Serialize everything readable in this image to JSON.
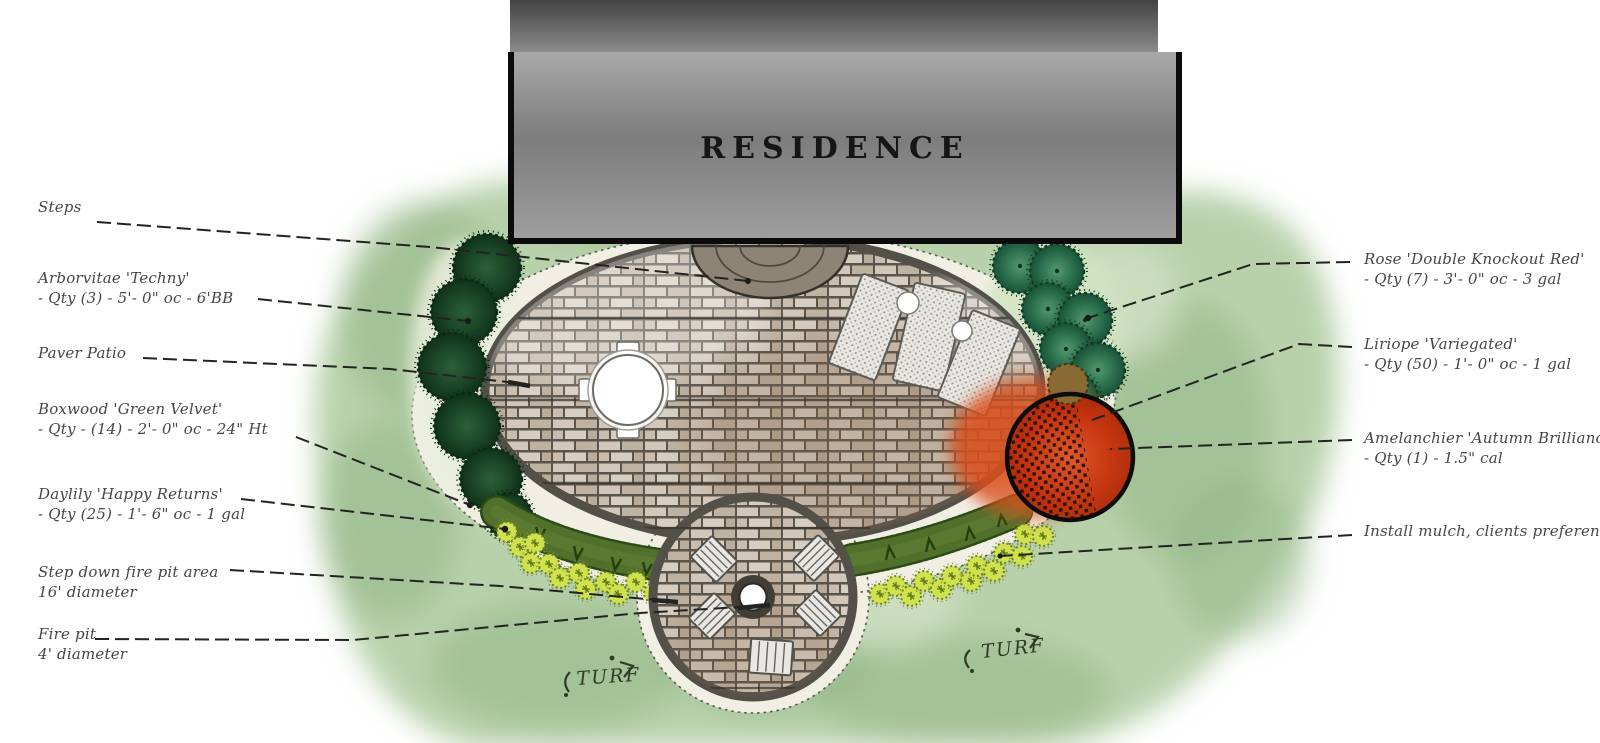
{
  "plan": {
    "residence_label": "RESIDENCE",
    "turf_labels": [
      "TURF",
      "TURF"
    ]
  },
  "labels_left": [
    {
      "line1": "Steps",
      "line2": ""
    },
    {
      "line1": "Arborvitae 'Techny'",
      "line2": "- Qty (3) - 5'- 0\" oc - 6'BB"
    },
    {
      "line1": "Paver Patio",
      "line2": ""
    },
    {
      "line1": "Boxwood 'Green Velvet'",
      "line2": "- Qty - (14) - 2'- 0\" oc - 24\" Ht"
    },
    {
      "line1": "Daylily 'Happy Returns'",
      "line2": "- Qty (25) - 1'- 6\" oc - 1 gal"
    },
    {
      "line1": "Step down fire pit area",
      "line2": "16' diameter"
    },
    {
      "line1": "Fire pit",
      "line2": "4' diameter"
    }
  ],
  "labels_right": [
    {
      "line1": "Rose 'Double Knockout Red'",
      "line2": "- Qty (7) - 3'- 0\" oc - 3 gal"
    },
    {
      "line1": "Liriope 'Variegated'",
      "line2": "- Qty (50) - 1'- 0\" oc - 1 gal"
    },
    {
      "line1": "Amelanchier 'Autumn Brilliance'",
      "line2": "- Qty (1) - 1.5\" cal"
    },
    {
      "line1": "Install mulch, clients preference",
      "line2": ""
    }
  ],
  "palette": {
    "turf_green": "#b8d1ab",
    "bed_mulch": "#f1efe4",
    "paver_tan": "#c9bcae",
    "patio_edge_gray": "#53504a",
    "arborvitae_green": "#1b4527",
    "rose_green": "#2f7350",
    "boxwood_green": "#51702c",
    "daylily_yellow": "#cfe14f",
    "amelanchier_red": "#cc3a12",
    "residence_gray": "#8a8a8a",
    "label_ink": "#464646"
  }
}
